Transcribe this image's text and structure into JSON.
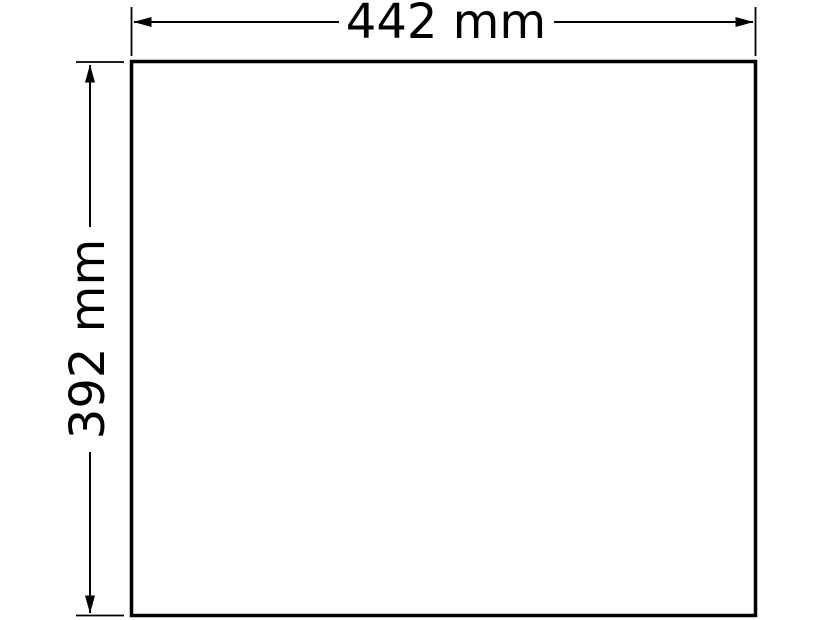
{
  "colors": {
    "line": "#000000",
    "background": "#ffffff"
  },
  "drawing": {
    "type": "technical-dimension-diagram",
    "shape": "rectangle",
    "width_dimension": {
      "label": "442 mm",
      "value": 442,
      "unit": "mm"
    },
    "height_dimension": {
      "label": "392 mm",
      "value": 392,
      "unit": "mm"
    }
  }
}
